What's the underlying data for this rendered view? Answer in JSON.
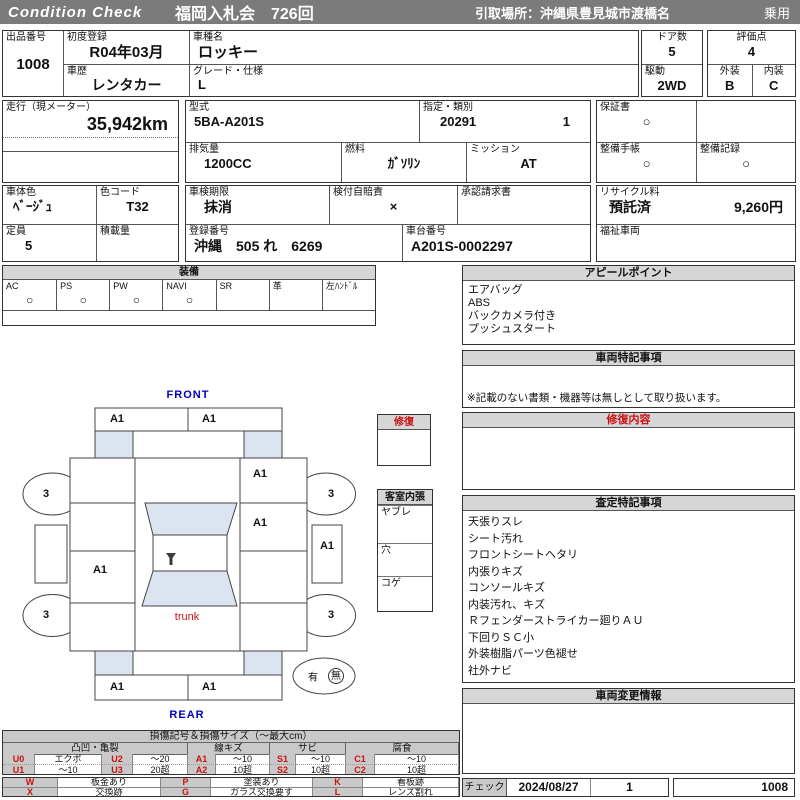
{
  "header": {
    "brand": "Condition  Check",
    "auction": "福岡入札会　726回",
    "pickup": "引取場所：沖縄県豊見城市渡橋名",
    "category": "乗用"
  },
  "vehicle": {
    "lot_label": "出品番号",
    "lot_no": "1008",
    "first_reg_label": "初度登録",
    "first_reg": "R04年03月",
    "model_label": "車種名",
    "model": "ロッキー",
    "history_label": "車歴",
    "history": "レンタカー",
    "grade_label": "グレード・仕様",
    "grade": "L",
    "doors_label": "ドア数",
    "doors": "5",
    "drive_label": "駆動",
    "drive": "2WD",
    "score_label": "評価点",
    "score": "4",
    "exterior_label": "外装",
    "exterior_grade": "B",
    "interior_label": "内装",
    "interior_grade": "C",
    "mileage_label": "走行（現メーター）",
    "mileage": "35,942km",
    "model_code_label": "型式",
    "model_code": "5BA-A201S",
    "class_label": "指定・類別",
    "class_no": "20291",
    "class_sub": "1",
    "displacement_label": "排気量",
    "displacement": "1200CC",
    "fuel_label": "燃料",
    "fuel": "ｶﾞｿﾘﾝ",
    "transmission_label": "ミッション",
    "transmission": "AT",
    "warranty_label": "保証書",
    "warranty": "○",
    "maintenance_book_label": "整備手帳",
    "maintenance_book": "○",
    "maintenance_record_label": "整備記録",
    "maintenance_record": "○",
    "body_color_label": "車体色",
    "body_color": "ﾍﾞｰｼﾞｭ",
    "color_code_label": "色コード",
    "color_code": "T32",
    "inspection_label": "車検期限",
    "inspection": "抹消",
    "insurance_label": "検付自賠責",
    "insurance": "×",
    "approval_label": "承認請求書",
    "approval": "",
    "recycle_label": "リサイクル料",
    "recycle_status": "預託済",
    "recycle_fee": "9,260円",
    "capacity_label": "定員",
    "capacity": "5",
    "payload_label": "積載量",
    "payload": "",
    "plate_label": "登録番号",
    "plate": "沖縄　505 れ　6269",
    "chassis_label": "車台番号",
    "chassis_no": "A201S-0002297",
    "welfare_label": "福祉車両",
    "welfare": ""
  },
  "equipment": {
    "title": "装備",
    "items": [
      {
        "label": "AC",
        "value": "○"
      },
      {
        "label": "PS",
        "value": "○"
      },
      {
        "label": "PW",
        "value": "○"
      },
      {
        "label": "NAVI",
        "value": "○"
      },
      {
        "label": "SR",
        "value": ""
      },
      {
        "label": "革",
        "value": ""
      },
      {
        "label": "左ﾊﾝﾄﾞﾙ",
        "value": ""
      }
    ]
  },
  "appeal": {
    "title": "アピールポイント",
    "items": [
      "エアバッグ",
      "ABS",
      "バックカメラ付き",
      "プッシュスタート"
    ]
  },
  "vehicle_notes": {
    "title": "車両特記事項",
    "footnote": "※記載のない書類・機器等は無しとして取り扱います。"
  },
  "repair": {
    "title": "修復内容"
  },
  "assessment": {
    "title": "査定特記事項",
    "items": [
      "天張りスレ",
      "シート汚れ",
      "フロントシートヘタリ",
      "内張りキズ",
      "コンソールキズ",
      "内装汚れ、キズ",
      "Ｒフェンダーストライカー廻りＡＵ",
      "下回りＳＣ小",
      "外装樹脂パーツ色褪せ",
      "社外ナビ"
    ]
  },
  "change_info": {
    "title": "車両変更情報"
  },
  "check": {
    "label": "チェック",
    "date": "2024/08/27",
    "count": "1",
    "lot_no": "1008"
  },
  "diagram": {
    "front_label": "FRONT",
    "rear_label": "REAR",
    "trunk_label": "trunk",
    "marks": {
      "front_bumper_left": "A1",
      "front_bumper_right": "A1",
      "right_front_fender": "A1",
      "right_front_door": "A1",
      "right_rocker": "A1",
      "left_rear_door": "A1",
      "rear_bumper_left": "A1",
      "rear_bumper_right": "A1",
      "wheel_front_left": "3",
      "wheel_front_right": "3",
      "wheel_rear_left": "3",
      "wheel_rear_right": "3"
    },
    "repair_box_title": "修復",
    "cabin_box": {
      "title": "客室内張",
      "rows": [
        "ヤブレ",
        "穴",
        "コゲ"
      ]
    },
    "spare": {
      "has": "有",
      "none": "無"
    }
  },
  "legend": {
    "title": "損傷記号＆損傷サイズ（～最大cm）",
    "groups": [
      "凸凹・亀裂",
      "線キズ",
      "サビ",
      "腐食"
    ],
    "rows": [
      [
        "U0",
        "エクボ",
        "U2",
        "～20",
        "A1",
        "～10",
        "S1",
        "～10",
        "C1",
        "～10"
      ],
      [
        "U1",
        "～10",
        "U3",
        "20超",
        "A2",
        "10超",
        "S2",
        "10超",
        "C2",
        "10超"
      ]
    ],
    "marks": [
      [
        "W",
        "板金あり",
        "P",
        "塗装あり",
        "K",
        "看板跡"
      ],
      [
        "X",
        "交換跡",
        "G",
        "ガラス交換要す",
        "L",
        "レンズ割れ"
      ]
    ]
  },
  "colors": {
    "bar_gray": "#7b7b7b",
    "panel_gray": "#d6d6d6",
    "glass_blue": "#dce4f0",
    "accent_red": "#cc1111",
    "accent_blue": "#0000bb"
  }
}
